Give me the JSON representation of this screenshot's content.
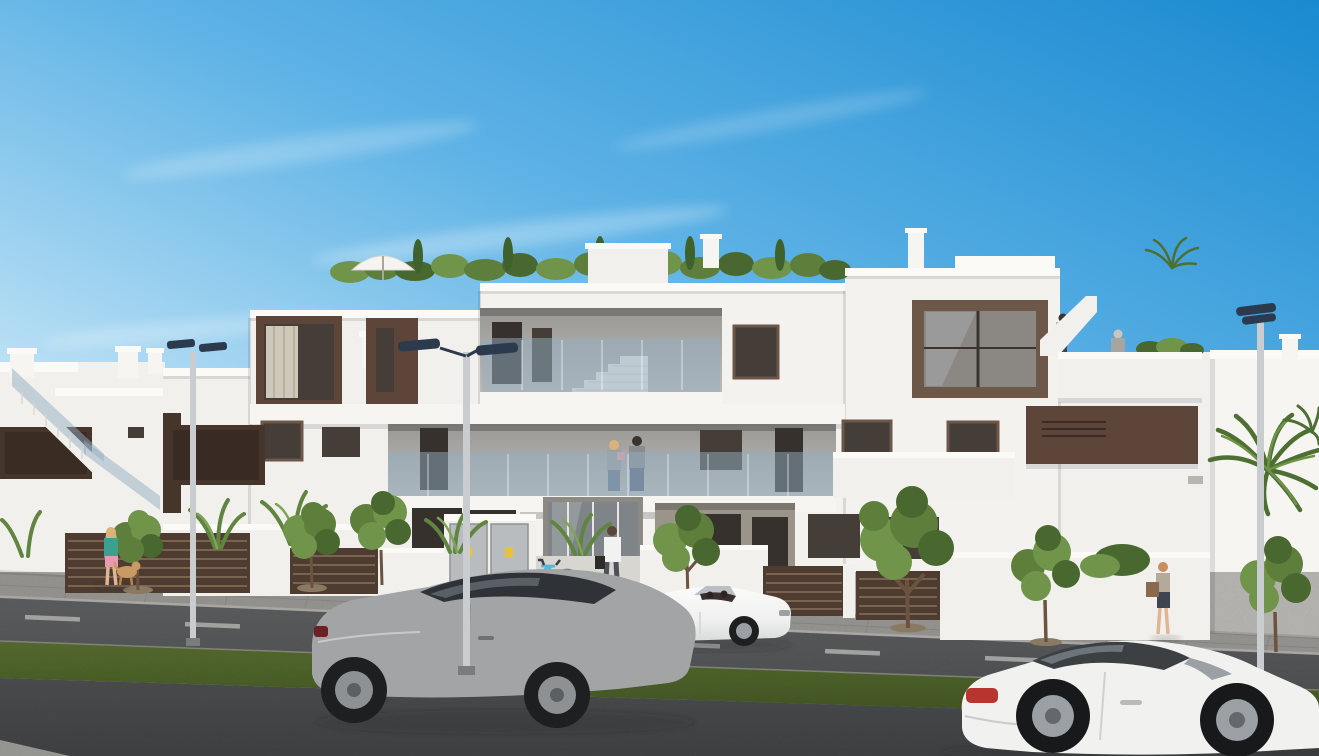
{
  "meta": {
    "kind": "architectural 3D render (photorealistic visualization)",
    "subject": "modern white three-storey apartment complex with dark-brown accent panels, seen from the street on a sunny day",
    "canvas": {
      "width_px": 1319,
      "height_px": 756
    },
    "visible_text": "none"
  },
  "palette": {
    "sky_top": "#1a8ad0",
    "sky_mid": "#5fb3e6",
    "sky_horizon": "#d6eef9",
    "facade_white": "#f2f0ec",
    "facade_bright": "#f7f5f1",
    "parapet_cap": "#fcfaf6",
    "recess_wall": "#b4b2af",
    "accent_brown": "#5e4539",
    "accent_brown_dark": "#46352b",
    "window_glass": "#453e38",
    "window_frame": "#6d5748",
    "balcony_glass": "rgba(148,174,194,0.5)",
    "sidewalk": "#cac9c4",
    "curb": "#e9e7e2",
    "road": "#75777a",
    "road_foreground": "#5d6063",
    "grass_median": "#68833c",
    "foliage_light": "#6f944a",
    "foliage_dark": "#49682f",
    "fence_brown": "#4e3c30",
    "lamp_head_navy": "#2c3a4e",
    "lamp_pole_grey": "#c9cdd0",
    "car_silver": "#a3a4a6",
    "car_white": "#f1f2f0",
    "taillight_red": "#b8342e",
    "bicycle_blue": "#58b6da",
    "utility_cabinet_grey": "#b9bcbe",
    "warning_sticker_yellow": "#e6c33a"
  },
  "scene": {
    "sky": {
      "description": "clear blue sky, deepest at top right, fading pale toward the rooftops",
      "cloud_wisps": 4
    },
    "buildings": {
      "main_complex": {
        "storeys": 3,
        "style": "flat-roof white render, dark-brown accent panels, brown-framed windows",
        "features": [
          "roof terrace with hedge, cypresses and white parasol",
          "open-air corridors with frameless glass balustrades",
          "internal stair visible on top-floor corridor",
          "right tower with large brown-framed glazing and external stair",
          "right roof terrace with parapet",
          "recessed ground-floor porches",
          "glass entrance doors"
        ]
      },
      "left_background_block": "white apartment block with switchback external staircase, glass balustrade, dark-brown band and rooftop vent chimneys",
      "right_background": "low sunlit white wall and neighbouring white house with palm trees"
    },
    "street": {
      "layout_back_to_front": [
        "garden walls and fences",
        "paved sidewalk",
        "far traffic lane with dashed white centerline",
        "green median strip",
        "near traffic lane"
      ],
      "street_lamps": 3,
      "lamp_style": "twin rectangular navy heads on grey poles"
    },
    "vehicles": [
      {
        "type": "luxury coupe",
        "color": "silver grey",
        "position": "centre-left on near lane, facing right"
      },
      {
        "type": "convertible roadster, top down",
        "color": "white",
        "position": "parked at curb right of the entrance"
      },
      {
        "type": "sports coupe",
        "color": "white",
        "position": "foreground bottom right, facing right"
      }
    ],
    "people": [
      {
        "who": "woman walking a small dog",
        "where": "left sidewalk"
      },
      {
        "who": "couple, woman holding a child",
        "where": "first-floor walkway behind glass balustrade"
      },
      {
        "who": "man in white shirt with briefcase",
        "where": "walking toward entrance"
      },
      {
        "who": "man in light-blue shirt",
        "where": "climbing right external stair"
      },
      {
        "who": "woman",
        "where": "right roof terrace behind parapet"
      },
      {
        "who": "woman with shoulder bag",
        "where": "right sidewalk"
      }
    ],
    "vegetation": [
      "rooftop hedge with cypresses",
      "small curb-side trees in sidewalk pits",
      "banana / strelitzia plants behind garden walls",
      "bushes",
      "palm fronds at right edge",
      "small rooftop palm"
    ],
    "objects": [
      "light-blue bicycle at rack near entrance",
      "grey utility cabinets with yellow warning labels",
      "dark-brown slatted fence panels",
      "white parasol",
      "wall light on right wing"
    ]
  }
}
